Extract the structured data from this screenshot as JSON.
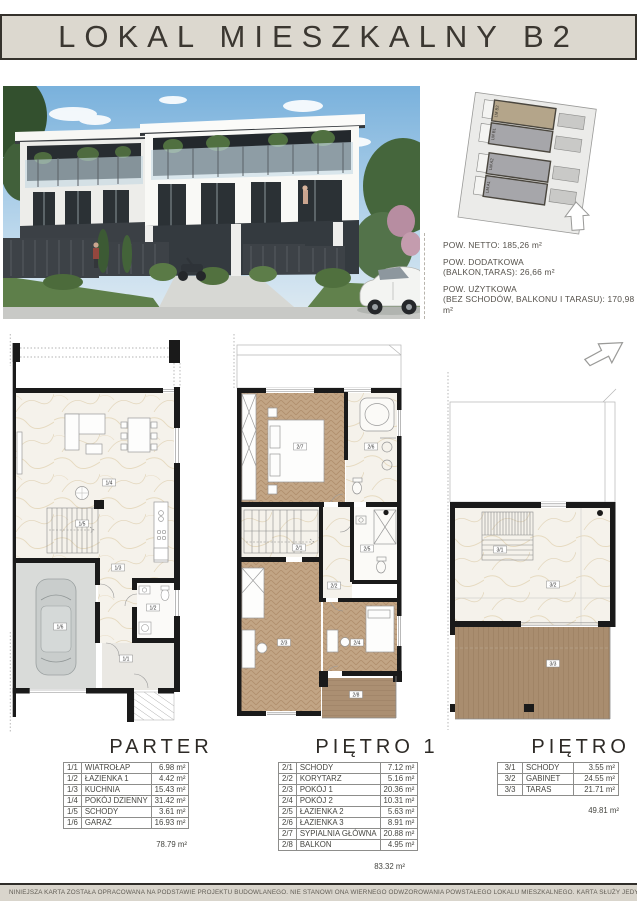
{
  "header": {
    "title": "LOKAL MIESZKALNY B2"
  },
  "site_plan": {
    "units": [
      {
        "label": "LM B2"
      },
      {
        "label": "LM B1"
      },
      {
        "label": "LM A2"
      },
      {
        "label": "LM A1"
      }
    ]
  },
  "areas": [
    {
      "line1": "POW. NETTO: 185,26 m²",
      "line2": ""
    },
    {
      "line1": "POW. DODATKOWA",
      "line2": "(BALKON,TARAS): 26,66 m²"
    },
    {
      "line1": "POW. UŻYTKOWA",
      "line2": "(BEZ SCHODÓW, BALKONU I TARASU): 170,98 m²"
    }
  ],
  "floors": [
    {
      "title": "PARTER",
      "rows": [
        {
          "id": "1/1",
          "name": "WIATROŁAP",
          "area": "6.98 m²"
        },
        {
          "id": "1/2",
          "name": "ŁAZIENKA 1",
          "area": "4.42 m²"
        },
        {
          "id": "1/3",
          "name": "KUCHNIA",
          "area": "15.43 m²"
        },
        {
          "id": "1/4",
          "name": "POKÓJ DZIENNY",
          "area": "31.42 m²"
        },
        {
          "id": "1/5",
          "name": "SCHODY",
          "area": "3.61 m²"
        },
        {
          "id": "1/6",
          "name": "GARAŻ",
          "area": "16.93 m²"
        }
      ],
      "total": "78.79 m²"
    },
    {
      "title": "PIĘTRO 1",
      "rows": [
        {
          "id": "2/1",
          "name": "SCHODY",
          "area": "7.12 m²"
        },
        {
          "id": "2/2",
          "name": "KORYTARZ",
          "area": "5.16 m²"
        },
        {
          "id": "2/3",
          "name": "POKÓJ 1",
          "area": "20.36 m²"
        },
        {
          "id": "2/4",
          "name": "POKÓJ 2",
          "area": "10.31 m²"
        },
        {
          "id": "2/5",
          "name": "ŁAZIENKA 2",
          "area": "5.63 m²"
        },
        {
          "id": "2/6",
          "name": "ŁAZIENKA 3",
          "area": "8.91 m²"
        },
        {
          "id": "2/7",
          "name": "SYPIALNIA GŁÓWNA",
          "area": "20.88 m²"
        },
        {
          "id": "2/8",
          "name": "BALKON",
          "area": "4.95 m²"
        }
      ],
      "total": "83.32 m²"
    },
    {
      "title": "PIĘTRO 2",
      "rows": [
        {
          "id": "3/1",
          "name": "SCHODY",
          "area": "3.55 m²"
        },
        {
          "id": "3/2",
          "name": "GABINET",
          "area": "24.55 m²"
        },
        {
          "id": "3/3",
          "name": "TARAS",
          "area": "21.71 m²"
        }
      ],
      "total": "49.81 m²"
    }
  ],
  "footer": {
    "disclaimer": "NINIEJSZA KARTA ZOSTAŁA OPRACOWANA NA PODSTAWIE PROJEKTU BUDOWLANEGO. NIE STANOWI ONA WIERNEGO ODWZOROWANIA POWSTAŁEGO LOKALU MIESZKALNEGO. KARTA SŁUŻY JEDYNIE DO"
  },
  "colors": {
    "banner_bg": "#dcd8cf",
    "footer_bg": "#d9d5cc",
    "wall": "#1a1a1a",
    "marble_floor": "#f5f2eb",
    "wood_floor": "#c2a585",
    "deck": "#a98d6f",
    "garage_floor": "#d9dbd9",
    "highlight_unit": "#b4a58a"
  }
}
